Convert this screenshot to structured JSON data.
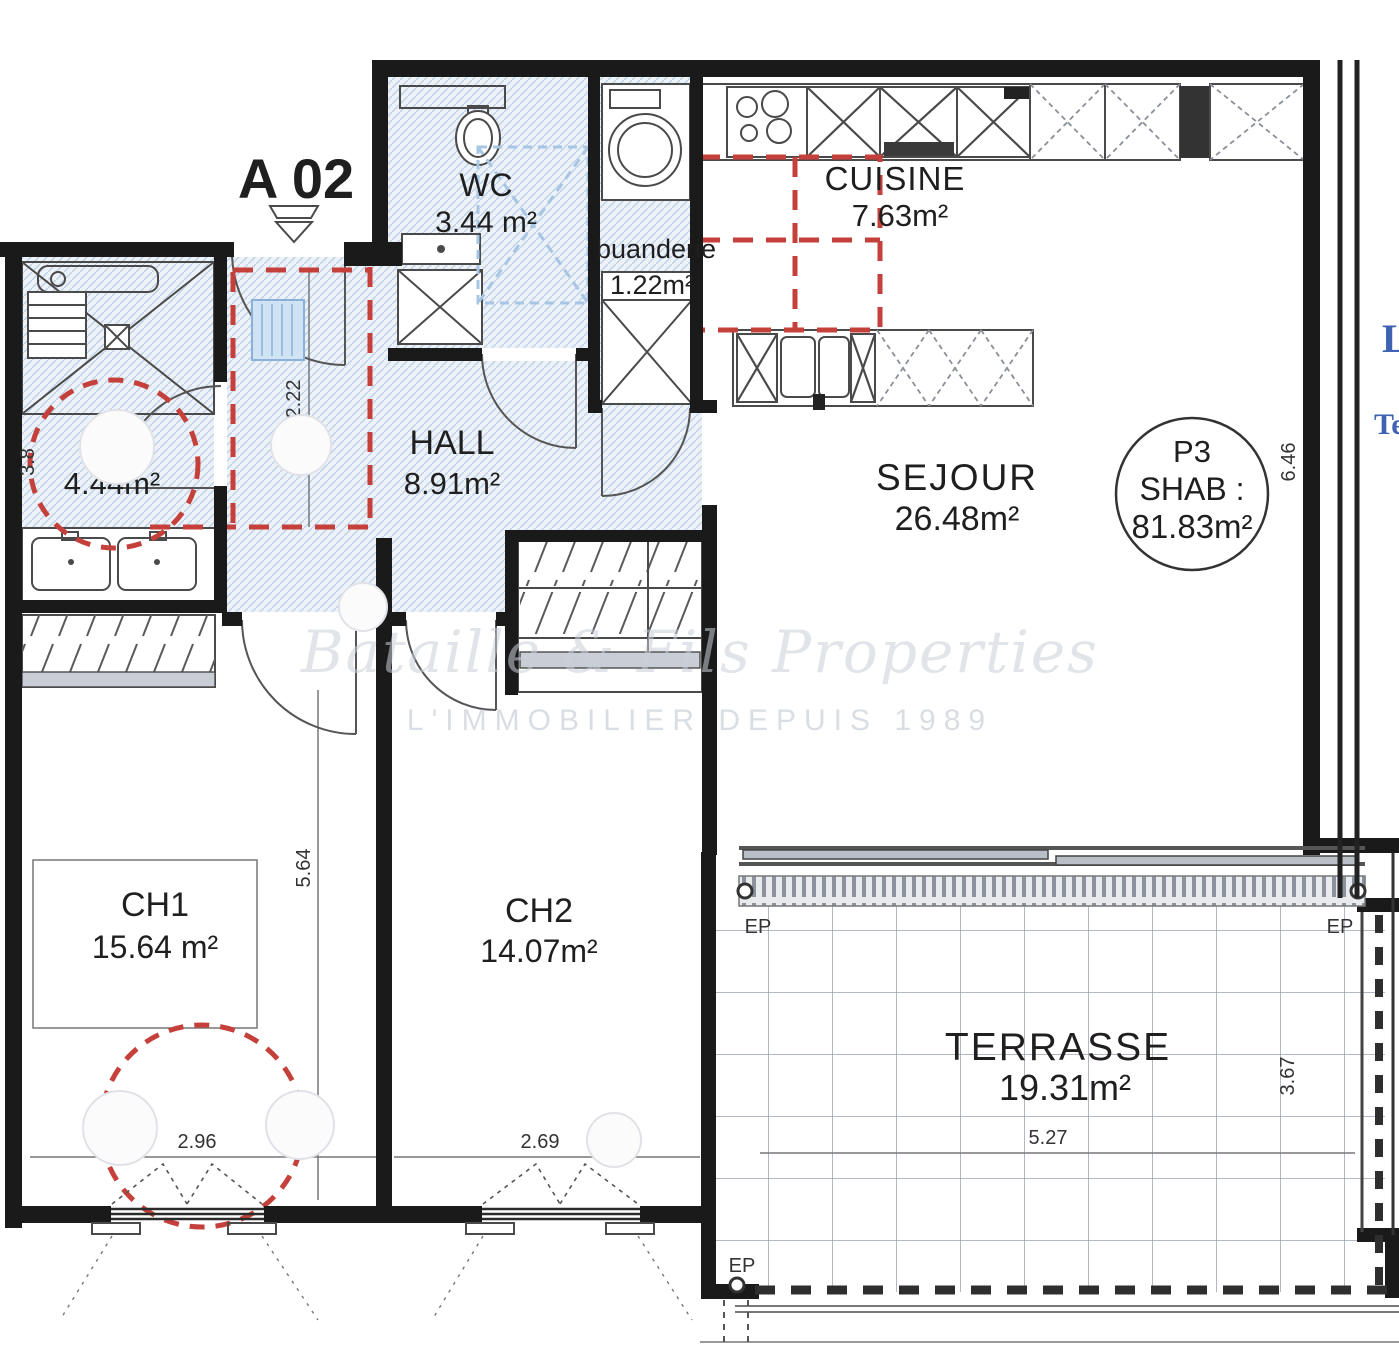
{
  "unit": {
    "label": "A 02"
  },
  "lot": {
    "code": "P3",
    "label": "SHAB :",
    "area": "81.83m²"
  },
  "rooms": {
    "wc": {
      "name": "WC",
      "area": "3.44 m²"
    },
    "buanderie": {
      "name": "buanderie",
      "area": "1.22m²"
    },
    "cuisine": {
      "name": "CUISINE",
      "area": "7.63m²"
    },
    "hall": {
      "name": "HALL",
      "area": "8.91m²"
    },
    "sde": {
      "name": "SDE",
      "area": "4.44m²"
    },
    "sejour": {
      "name": "SEJOUR",
      "area": "26.48m²"
    },
    "ch1": {
      "name": "CH1",
      "area": "15.64 m²"
    },
    "ch2": {
      "name": "CH2",
      "area": "14.07m²"
    },
    "terrasse": {
      "name": "TERRASSE",
      "area": "19.31m²"
    }
  },
  "dimensions": {
    "hall_depth": "2.22",
    "ch1_depth": "5.64",
    "ch1_width": "2.96",
    "ch2_width": "2.69",
    "terrasse_width": "5.27",
    "terrasse_depth": "3.67",
    "sejour_depth": "6.46",
    "sde_width": "3.8"
  },
  "annotations": {
    "rainwater": "EP",
    "edge_text_top": "L",
    "edge_text_bottom": "Te"
  },
  "watermark": {
    "line1": "Bataille & Fils Properties",
    "line2": "L'IMMOBILIER DEPUIS 1989"
  },
  "colors": {
    "wall": "#1a1a1a",
    "red_zone": "#c5403a",
    "hatch_blue": "#b9cde4",
    "blue_accent": "#3f63b2",
    "terrace_grid": "#97a0ad"
  }
}
